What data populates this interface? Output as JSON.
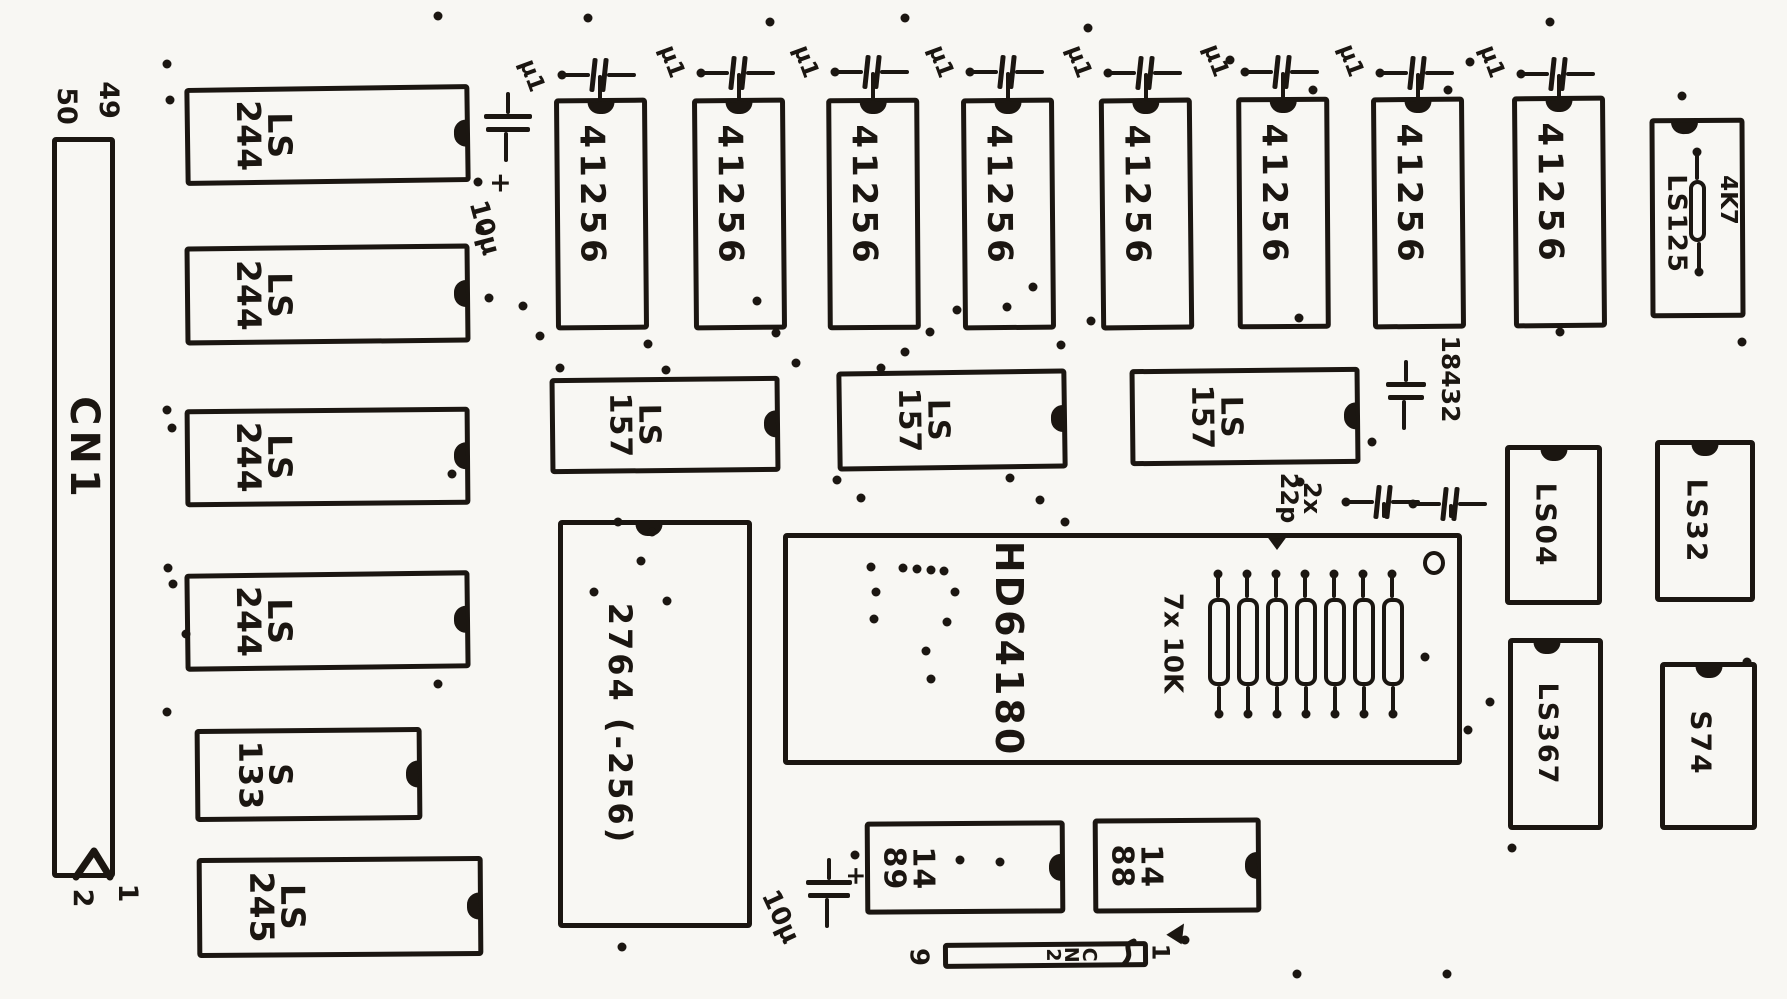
{
  "board": {
    "width": 1787,
    "height": 999,
    "background": "#f8f7f3",
    "ink": "#1b1611"
  },
  "connector_cn1": {
    "label": "CN1",
    "pin_top_left": "50",
    "pin_top_right": "49",
    "pin_bottom_left": "2",
    "pin_bottom_right": "1"
  },
  "connector_cn2": {
    "label": "CN2",
    "pin_left": "9",
    "pin_right": "1"
  },
  "chips": [
    {
      "id": "cn1",
      "label": "CN1",
      "x": 52,
      "y": 137,
      "w": 63,
      "h": 741,
      "notch": "none",
      "lx": 0.5,
      "ly": 0.42,
      "fs": 40,
      "rot": 0,
      "ls": 5
    },
    {
      "id": "ls244-1",
      "label": "LS\n244",
      "x": 185,
      "y": 86,
      "w": 285,
      "h": 98,
      "notch": "right",
      "lx": 0.27,
      "ly": 0.5,
      "fs": 33,
      "rot": -0.8,
      "ls": 1
    },
    {
      "id": "ls244-2",
      "label": "LS\n244",
      "x": 185,
      "y": 245,
      "w": 285,
      "h": 99,
      "notch": "right",
      "lx": 0.27,
      "ly": 0.5,
      "fs": 33,
      "rot": -0.6,
      "ls": 1
    },
    {
      "id": "ls244-3",
      "label": "LS\n244",
      "x": 185,
      "y": 408,
      "w": 285,
      "h": 98,
      "notch": "right",
      "lx": 0.27,
      "ly": 0.5,
      "fs": 33,
      "rot": -0.5,
      "ls": 1
    },
    {
      "id": "ls244-4",
      "label": "LS\n244",
      "x": 185,
      "y": 572,
      "w": 285,
      "h": 98,
      "notch": "right",
      "lx": 0.27,
      "ly": 0.5,
      "fs": 33,
      "rot": -0.7,
      "ls": 1
    },
    {
      "id": "s133",
      "label": "S\n133",
      "x": 195,
      "y": 728,
      "w": 227,
      "h": 93,
      "notch": "right",
      "lx": 0.3,
      "ly": 0.5,
      "fs": 32,
      "rot": -0.5,
      "ls": 1
    },
    {
      "id": "ls245",
      "label": "LS\n245",
      "x": 197,
      "y": 857,
      "w": 286,
      "h": 100,
      "notch": "right",
      "lx": 0.27,
      "ly": 0.5,
      "fs": 33,
      "rot": -0.4,
      "ls": 1
    },
    {
      "id": "41256-1",
      "label": "41256",
      "x": 555,
      "y": 98,
      "w": 93,
      "h": 232,
      "notch": "top",
      "nx": 0.5,
      "lx": 0.38,
      "ly": 0.42,
      "fs": 34,
      "rot": -0.5,
      "ls": 5
    },
    {
      "id": "41256-2",
      "label": "41256",
      "x": 693,
      "y": 98,
      "w": 93,
      "h": 232,
      "notch": "top",
      "nx": 0.5,
      "lx": 0.38,
      "ly": 0.42,
      "fs": 34,
      "rot": -0.5,
      "ls": 5
    },
    {
      "id": "41256-3",
      "label": "41256",
      "x": 827,
      "y": 98,
      "w": 93,
      "h": 232,
      "notch": "top",
      "nx": 0.5,
      "lx": 0.38,
      "ly": 0.42,
      "fs": 34,
      "rot": -0.4,
      "ls": 5
    },
    {
      "id": "41256-4",
      "label": "41256",
      "x": 962,
      "y": 98,
      "w": 93,
      "h": 232,
      "notch": "top",
      "nx": 0.5,
      "lx": 0.38,
      "ly": 0.42,
      "fs": 34,
      "rot": -0.5,
      "ls": 5
    },
    {
      "id": "41256-5",
      "label": "41256",
      "x": 1100,
      "y": 98,
      "w": 93,
      "h": 232,
      "notch": "top",
      "nx": 0.5,
      "lx": 0.38,
      "ly": 0.42,
      "fs": 34,
      "rot": -0.6,
      "ls": 5
    },
    {
      "id": "41256-6",
      "label": "41256",
      "x": 1237,
      "y": 97,
      "w": 93,
      "h": 232,
      "notch": "top",
      "nx": 0.5,
      "lx": 0.38,
      "ly": 0.42,
      "fs": 34,
      "rot": -0.4,
      "ls": 5
    },
    {
      "id": "41256-7",
      "label": "41256",
      "x": 1372,
      "y": 97,
      "w": 93,
      "h": 232,
      "notch": "top",
      "nx": 0.5,
      "lx": 0.38,
      "ly": 0.42,
      "fs": 34,
      "rot": -0.5,
      "ls": 5
    },
    {
      "id": "41256-8",
      "label": "41256",
      "x": 1513,
      "y": 96,
      "w": 93,
      "h": 232,
      "notch": "top",
      "nx": 0.5,
      "lx": 0.38,
      "ly": 0.42,
      "fs": 34,
      "rot": -0.5,
      "ls": 5
    },
    {
      "id": "ls125",
      "label": "LS125",
      "x": 1650,
      "y": 118,
      "w": 95,
      "h": 200,
      "notch": "top",
      "nx": 0.35,
      "lx": 0.25,
      "ly": 0.53,
      "fs": 26,
      "rot": -0.3,
      "ls": 2
    },
    {
      "id": "ls157-1",
      "label": "LS\n157",
      "x": 550,
      "y": 377,
      "w": 230,
      "h": 96,
      "notch": "right",
      "lx": 0.36,
      "ly": 0.5,
      "fs": 30,
      "rot": -0.6,
      "ls": 1
    },
    {
      "id": "ls157-2",
      "label": "LS\n157",
      "x": 837,
      "y": 370,
      "w": 230,
      "h": 100,
      "notch": "right",
      "lx": 0.37,
      "ly": 0.5,
      "fs": 30,
      "rot": -0.8,
      "ls": 1
    },
    {
      "id": "ls157-3",
      "label": "LS\n157",
      "x": 1130,
      "y": 368,
      "w": 230,
      "h": 97,
      "notch": "right",
      "lx": 0.37,
      "ly": 0.5,
      "fs": 30,
      "rot": -0.6,
      "ls": 1
    },
    {
      "id": "2764",
      "label": "2764 (-256)",
      "x": 558,
      "y": 520,
      "w": 194,
      "h": 408,
      "notch": "top",
      "nx": 0.47,
      "lx": 0.31,
      "ly": 0.5,
      "fs": 32,
      "rot": 0,
      "ls": 3
    },
    {
      "id": "hd64180",
      "label": "HD64180",
      "x": 783,
      "y": 533,
      "w": 679,
      "h": 232,
      "notch": "tri",
      "nx": 0.72,
      "lx": 0.33,
      "ly": 0.5,
      "fs": 38,
      "rot": 0,
      "ls": 3,
      "pin1": true
    },
    {
      "id": "ls04",
      "label": "LS04",
      "x": 1505,
      "y": 445,
      "w": 97,
      "h": 160,
      "notch": "top",
      "nx": 0.5,
      "lx": 0.4,
      "ly": 0.5,
      "fs": 28,
      "rot": 0,
      "ls": 2
    },
    {
      "id": "ls32",
      "label": "LS32",
      "x": 1655,
      "y": 440,
      "w": 100,
      "h": 162,
      "notch": "top",
      "nx": 0.5,
      "lx": 0.4,
      "ly": 0.5,
      "fs": 28,
      "rot": 0,
      "ls": 2
    },
    {
      "id": "ls367",
      "label": "LS367",
      "x": 1508,
      "y": 638,
      "w": 95,
      "h": 192,
      "notch": "top",
      "nx": 0.4,
      "lx": 0.4,
      "ly": 0.5,
      "fs": 27,
      "rot": 0,
      "ls": 2
    },
    {
      "id": "s74",
      "label": "S74",
      "x": 1660,
      "y": 662,
      "w": 97,
      "h": 168,
      "notch": "top",
      "nx": 0.5,
      "lx": 0.4,
      "ly": 0.48,
      "fs": 28,
      "rot": 0,
      "ls": 2
    },
    {
      "id": "1489",
      "label": "14\n89",
      "x": 865,
      "y": 821,
      "w": 200,
      "h": 93,
      "notch": "right",
      "lx": 0.2,
      "ly": 0.5,
      "fs": 30,
      "rot": -0.4,
      "ls": 1
    },
    {
      "id": "1488",
      "label": "14\n88",
      "x": 1093,
      "y": 818,
      "w": 168,
      "h": 95,
      "notch": "right",
      "lx": 0.24,
      "ly": 0.5,
      "fs": 30,
      "rot": -0.4,
      "ls": 1
    },
    {
      "id": "cn2",
      "label": "C\nN\n2",
      "x": 943,
      "y": 942,
      "w": 205,
      "h": 26,
      "notch": "none",
      "lx": 0.63,
      "ly": 0.5,
      "fs": 19,
      "rot": -0.5,
      "ls": 0
    }
  ],
  "texts": [
    {
      "n": "pin-number-cn1-50",
      "t": "50",
      "x": 66,
      "y": 106,
      "fs": 27,
      "rot": 90
    },
    {
      "n": "pin-number-cn1-49",
      "t": "49",
      "x": 108,
      "y": 100,
      "fs": 27,
      "rot": 90
    },
    {
      "n": "pin-number-cn1-2",
      "t": "2",
      "x": 82,
      "y": 898,
      "fs": 27,
      "rot": 90
    },
    {
      "n": "pin-number-cn1-1",
      "t": "1",
      "x": 127,
      "y": 893,
      "fs": 27,
      "rot": 90
    },
    {
      "n": "pin-number-cn2-9",
      "t": "9",
      "x": 918,
      "y": 957,
      "fs": 26,
      "rot": 90
    },
    {
      "n": "pin-number-cn2-1",
      "t": "1",
      "x": 1160,
      "y": 952,
      "fs": 24,
      "rot": 90
    },
    {
      "n": "cap-value-u1-1",
      "t": "μ1",
      "x": 531,
      "y": 76,
      "fs": 23,
      "rot": 70
    },
    {
      "n": "cap-value-u1-2",
      "t": "μ1",
      "x": 671,
      "y": 62,
      "fs": 23,
      "rot": 70
    },
    {
      "n": "cap-value-u1-3",
      "t": "μ1",
      "x": 805,
      "y": 62,
      "fs": 23,
      "rot": 70
    },
    {
      "n": "cap-value-u1-4",
      "t": "μ1",
      "x": 940,
      "y": 62,
      "fs": 23,
      "rot": 70
    },
    {
      "n": "cap-value-u1-5",
      "t": "μ1",
      "x": 1078,
      "y": 62,
      "fs": 23,
      "rot": 70
    },
    {
      "n": "cap-value-u1-6",
      "t": "μ1",
      "x": 1215,
      "y": 61,
      "fs": 23,
      "rot": 70
    },
    {
      "n": "cap-value-u1-7",
      "t": "μ1",
      "x": 1350,
      "y": 61,
      "fs": 23,
      "rot": 70
    },
    {
      "n": "cap-value-u1-8",
      "t": "μ1",
      "x": 1491,
      "y": 62,
      "fs": 23,
      "rot": 70
    },
    {
      "n": "cap-polarity-top",
      "t": "+",
      "x": 500,
      "y": 183,
      "fs": 27,
      "rot": 90
    },
    {
      "n": "cap-value-10u-top",
      "t": "10μ",
      "x": 484,
      "y": 228,
      "fs": 26,
      "rot": 75
    },
    {
      "n": "cap-polarity-bottom",
      "t": "+",
      "x": 856,
      "y": 876,
      "fs": 25,
      "rot": 90
    },
    {
      "n": "cap-value-10u-bottom",
      "t": "10μ",
      "x": 780,
      "y": 917,
      "fs": 26,
      "rot": 65
    },
    {
      "n": "cap-value-22p",
      "t": "2x\n22p",
      "x": 1300,
      "y": 498,
      "fs": 24,
      "rot": 90
    },
    {
      "n": "resistor-network-value",
      "t": "7x 10K",
      "x": 1172,
      "y": 643,
      "fs": 26,
      "rot": 90
    },
    {
      "n": "crystal-value",
      "t": "18432",
      "x": 1450,
      "y": 379,
      "fs": 25,
      "rot": 90
    },
    {
      "n": "resistor-value-4k7",
      "t": "4K7",
      "x": 1727,
      "y": 200,
      "fs": 23,
      "rot": 90
    }
  ],
  "caps_horizontal": [
    {
      "cx": 598,
      "cy": 75,
      "stub": 27
    },
    {
      "cx": 737,
      "cy": 73,
      "stub": 28
    },
    {
      "cx": 871,
      "cy": 72,
      "stub": 29
    },
    {
      "cx": 1006,
      "cy": 72,
      "stub": 29
    },
    {
      "cx": 1144,
      "cy": 73,
      "stub": 28
    },
    {
      "cx": 1281,
      "cy": 72,
      "stub": 28
    },
    {
      "cx": 1416,
      "cy": 73,
      "stub": 27
    },
    {
      "cx": 1557,
      "cy": 74,
      "stub": 26
    },
    {
      "cx": 1382,
      "cy": 502,
      "stub": 16
    },
    {
      "cx": 1449,
      "cy": 504,
      "stub": 14
    }
  ],
  "caps_vertical": [
    {
      "id": "electrolytic-top",
      "x": 484,
      "y": 92,
      "w": 48
    },
    {
      "id": "electrolytic-bottom",
      "x": 806,
      "y": 858,
      "w": 46
    },
    {
      "id": "crystal-18432",
      "x": 1386,
      "y": 360,
      "w": 40
    }
  ],
  "resistor_network": {
    "count": 7,
    "x0": 1208,
    "pitch": 29,
    "body_w": 22,
    "body_h": 88,
    "body_top": 598,
    "stub_top": 572,
    "stub_bottom": 716
  },
  "pullup_resistor": {
    "x": 1689,
    "y": 180,
    "w": 17,
    "h": 62,
    "lead_top": 152,
    "lead_bottom": 272
  },
  "dots": [
    [
      167,
      64
    ],
    [
      170,
      100
    ],
    [
      438,
      16
    ],
    [
      478,
      182
    ],
    [
      480,
      230
    ],
    [
      167,
      410
    ],
    [
      172,
      428
    ],
    [
      168,
      568
    ],
    [
      173,
      584
    ],
    [
      186,
      634
    ],
    [
      167,
      712
    ],
    [
      438,
      684
    ],
    [
      452,
      474
    ],
    [
      489,
      298
    ],
    [
      523,
      306
    ],
    [
      540,
      336
    ],
    [
      560,
      368
    ],
    [
      648,
      344
    ],
    [
      666,
      370
    ],
    [
      652,
      532
    ],
    [
      905,
      352
    ],
    [
      930,
      332
    ],
    [
      957,
      310
    ],
    [
      881,
      368
    ],
    [
      1007,
      307
    ],
    [
      1033,
      287
    ],
    [
      1061,
      345
    ],
    [
      1091,
      321
    ],
    [
      757,
      301
    ],
    [
      776,
      333
    ],
    [
      796,
      363
    ],
    [
      618,
      522
    ],
    [
      641,
      561
    ],
    [
      667,
      601
    ],
    [
      594,
      592
    ],
    [
      871,
      567
    ],
    [
      876,
      592
    ],
    [
      903,
      568
    ],
    [
      917,
      569
    ],
    [
      931,
      570
    ],
    [
      944,
      571
    ],
    [
      955,
      592
    ],
    [
      947,
      622
    ],
    [
      926,
      651
    ],
    [
      931,
      679
    ],
    [
      874,
      619
    ],
    [
      1299,
      318
    ],
    [
      1372,
      442
    ],
    [
      1470,
      62
    ],
    [
      1300,
      482
    ],
    [
      1490,
      702
    ],
    [
      1512,
      848
    ],
    [
      1560,
      332
    ],
    [
      1742,
      342
    ],
    [
      1747,
      662
    ],
    [
      1297,
      974
    ],
    [
      1447,
      974
    ],
    [
      855,
      855
    ],
    [
      960,
      860
    ],
    [
      1000,
      862
    ],
    [
      622,
      947
    ],
    [
      1185,
      940
    ],
    [
      905,
      18
    ],
    [
      1088,
      28
    ],
    [
      770,
      22
    ],
    [
      1550,
      22
    ],
    [
      1682,
      96
    ],
    [
      1230,
      60
    ],
    [
      1425,
      657
    ],
    [
      1468,
      730
    ],
    [
      837,
      480
    ],
    [
      861,
      498
    ],
    [
      1010,
      478
    ],
    [
      1040,
      500
    ],
    [
      1065,
      522
    ],
    [
      588,
      18
    ],
    [
      1313,
      90
    ],
    [
      1448,
      90
    ]
  ]
}
